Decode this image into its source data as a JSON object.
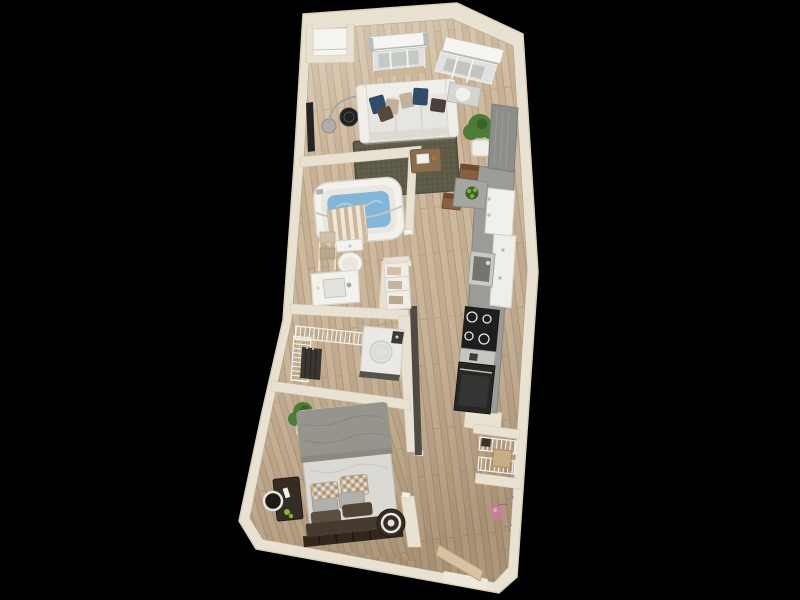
{
  "scene": {
    "title": "3D one-bedroom apartment floor plan",
    "description": "Top-down 3D dollhouse render of a one-bedroom, one-bath apartment on a black background: living room with sofa and two shaded windows at top, galley kitchen along the right wall, bathroom with tub and toilet at mid-left, walk-in closet with washer-dryer below it, bedroom at bottom-left and entry with open front door at bottom-right.",
    "view": "top-down 3D render",
    "background": "#000000"
  },
  "colors": {
    "bg": "#000000",
    "wall": "#e9e1d1",
    "wall_shade": "#d8cfbc",
    "wall_dark_edge": "#4f4a44",
    "floor": "#c3aa8c",
    "floor_light": "#d8c4a6",
    "floor_dark": "#a08667",
    "rug": "#5e5b49",
    "rug_dark": "#4f4c3c",
    "rug_light": "#6d6a56",
    "sofa": "#e6e5e0",
    "sofa_back": "#efeee9",
    "pillow_navy": "#2f4c6b",
    "pillow_tan": "#c3b19c",
    "pillow_brown": "#55483c",
    "wood_table": "#8a6c4e",
    "tv": "#232323",
    "porcelain": "#f3f2ed",
    "water": "#83b5d8",
    "water_light": "#b3d2e8",
    "curtain_a": "#efe8d9",
    "curtain_b": "#cbb89e",
    "counter": "#9b9b97",
    "cabinet_tall": "#8d8e8a",
    "cabinet_white": "#efeee9",
    "appliance_black": "#1e1e1e",
    "steel": "#c6c6c2",
    "fridge": "#f1f0ec",
    "washer_front": "#56534e",
    "wire_shelf": "#f5f3ed",
    "clothes": "#3a3632",
    "duvet": "#96948d",
    "sheet": "#dbd9d3",
    "pillow_pattern": "#c8b6a1",
    "pillow_gray": "#b2b0ab",
    "headboard": "#463930",
    "bench": "#33271c",
    "nightstand": "#352c23",
    "nightstand_ring": "#e9e7e1",
    "plant": "#4d7c38",
    "plant_dark": "#3a632a",
    "pot": "#efeee8",
    "door": "#d6c3a1",
    "basket": "#c6ad85",
    "bag_pink": "#c8809a",
    "chair_brown": "#8a5f40",
    "glass": "#dfe2e0",
    "shade_white": "#f6f5f1",
    "lamp": "#a8a6a2"
  },
  "floor_plan": {
    "unit": "1 bed / 1 bath",
    "rooms": [
      {
        "id": "living-room",
        "name": "Living Room",
        "items": [
          "two windows with roller shades",
          "three-seat sofa",
          "navy, tan and brown accent pillows",
          "dark olive area rug",
          "wood coffee table with book",
          "arc floor lamp",
          "round black side table",
          "wall-mounted TV",
          "potted plant",
          "desk with white chair"
        ]
      },
      {
        "id": "kitchen",
        "name": "Kitchen",
        "items": [
          "tall gray cabinet",
          "white cabinet run",
          "refrigerator",
          "single-basin sink",
          "4-burner cooktop",
          "oven",
          "stainless counter section",
          "dining table for two",
          "green fruit bowl",
          "two brown chairs"
        ]
      },
      {
        "id": "bathroom",
        "name": "Bathroom",
        "items": [
          "bathtub with water",
          "curved shower rod",
          "striped shower curtain",
          "toilet",
          "vanity with sink",
          "towel ladder",
          "linen shelves with towels"
        ]
      },
      {
        "id": "laundry-closet",
        "name": "Closet / Laundry",
        "items": [
          "wire shelving",
          "hanging clothes",
          "washer-dryer",
          "dark sliding door panel"
        ]
      },
      {
        "id": "bedroom",
        "name": "Bedroom",
        "items": [
          "bed with gray duvet",
          "patterned, gray and brown pillows",
          "slatted foot bench",
          "dark side table with bowl",
          "round drum nightstand",
          "potted plant"
        ]
      },
      {
        "id": "entry",
        "name": "Entry",
        "items": [
          "open front door",
          "coat hooks",
          "pink hanging bag",
          "wire shelf closet with basket"
        ]
      },
      {
        "id": "hallway",
        "name": "Hallway",
        "items": [
          "wood plank flooring"
        ]
      },
      {
        "id": "utility-closet",
        "name": "Utility Closet",
        "items": [
          "white storage shelf"
        ]
      }
    ]
  }
}
